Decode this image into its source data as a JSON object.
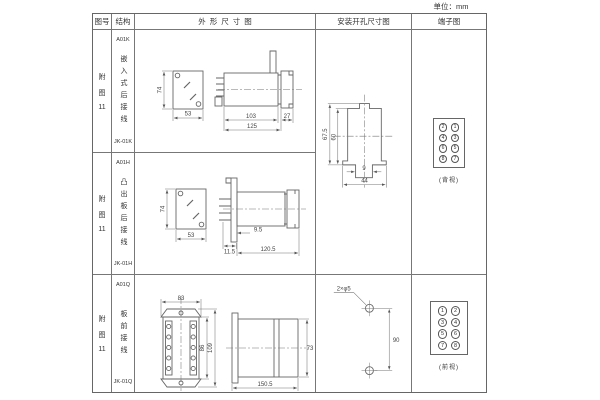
{
  "page": {
    "unit_label": "单位：mm"
  },
  "table": {
    "headers": {
      "fig_no": "图号",
      "structure": "结构",
      "outline": "外形尺寸图",
      "install": "安装开孔尺寸图",
      "terminal": "端子图"
    },
    "rows": [
      {
        "fig_lines": [
          "附",
          "图",
          "11"
        ],
        "code": "A01K",
        "desc": "嵌入式后接线",
        "model": "JK-01K",
        "dims": {
          "h": "74",
          "w": "53",
          "d1": "103",
          "d2": "27",
          "total": "125"
        }
      },
      {
        "fig_lines": [
          "附",
          "图",
          "11"
        ],
        "code": "A01H",
        "desc": "凸出板后接线",
        "model": "JK-01H",
        "dims": {
          "h": "74",
          "w": "53",
          "d1": "11.5",
          "d2": "9.5",
          "total": "120.5"
        }
      },
      {
        "fig_lines": [
          "附",
          "图",
          "11"
        ],
        "code": "A01Q",
        "desc": "板前接线",
        "model": "JK-01Q",
        "dims": {
          "w": "83",
          "inner_h": "86",
          "outer_h": "109",
          "depth": "150.5",
          "side_h": "73"
        }
      }
    ],
    "install": {
      "cutout": {
        "outer_h": "67.5",
        "inner_h": "60",
        "tab": "9",
        "width": "44"
      },
      "holes": {
        "label": "2×φ5",
        "spacing": "90"
      }
    },
    "terminals": {
      "rear": {
        "numbers": [
          "2",
          "1",
          "4",
          "3",
          "6",
          "5",
          "8",
          "7"
        ],
        "view": "(背视)"
      },
      "front": {
        "numbers": [
          "1",
          "2",
          "3",
          "4",
          "5",
          "6",
          "7",
          "8"
        ],
        "view": "(前视)"
      }
    }
  }
}
